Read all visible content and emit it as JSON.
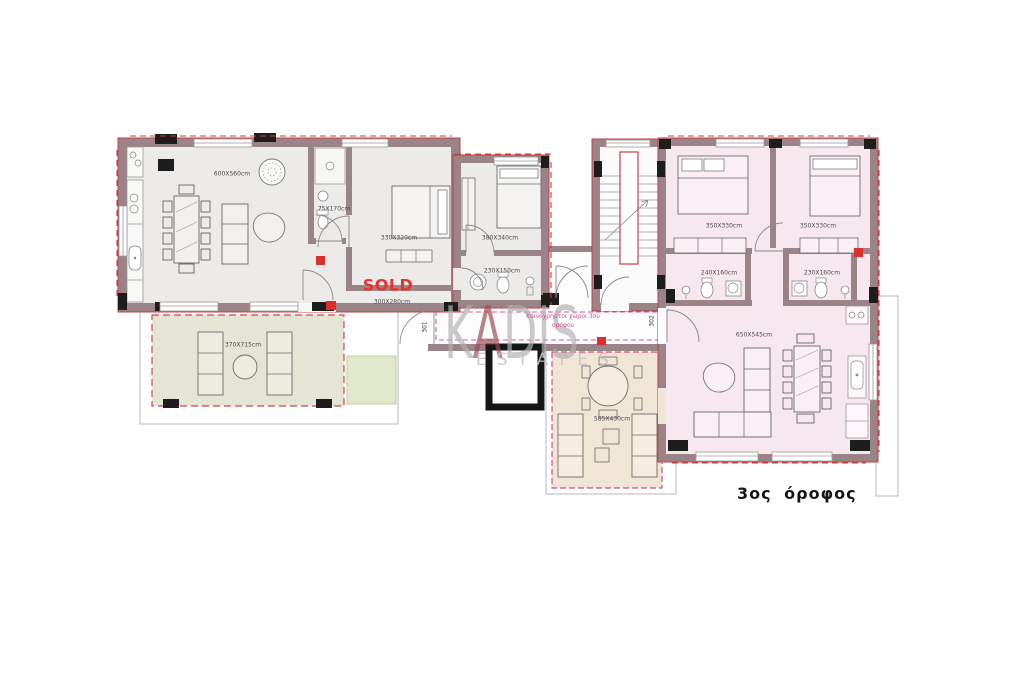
{
  "floor": {
    "title": "3ος όροφος"
  },
  "watermark": {
    "k": "K",
    "a": "A",
    "dis": "DIS",
    "estates": "ESTATES"
  },
  "common_area": {
    "line1": "Κοινόχρηστοι χώροι 3ου",
    "line2": "ορόφου"
  },
  "left_apartment": {
    "status": "SOLD",
    "door_number": "301",
    "living_dining": "600X560cm",
    "bathroom_small": "75X170cm",
    "bedroom_1": "330X320cm",
    "bedroom_2": "380X340cm",
    "bathroom_main": "230X150cm",
    "hall": "300X280cm",
    "balcony": "370X715cm"
  },
  "right_apartment": {
    "door_number": "302",
    "bedroom_1": "350X330cm",
    "bedroom_2": "350X330cm",
    "bathroom_1": "240X160cm",
    "bathroom_2": "230X160cm",
    "living_dining": "650X545cm",
    "balcony": "585X430cm"
  },
  "colors": {
    "wall": "#9a8487",
    "wall_outline_red": "#c24046",
    "floor_gray": "#ecebe9",
    "floor_pink": "#f7e8ef",
    "balcony_sage": "#e4e5d4",
    "balcony_beige": "#f1e5d6",
    "garden_green": "#e1e9cd",
    "sold_red": "#e8322d",
    "common_label_pink": "#c94f93",
    "watermark_gray": "#b3b0b1",
    "watermark_accent": "#9d4a51"
  }
}
